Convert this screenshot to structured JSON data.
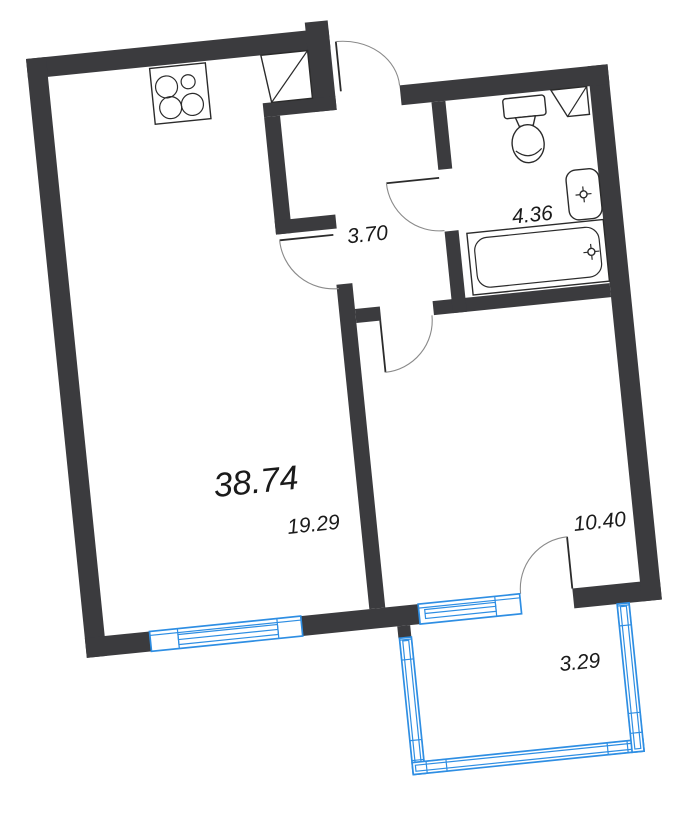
{
  "plan": {
    "type": "apartment-floor-plan",
    "rotation_deg": -5.8,
    "colors": {
      "wall": "#3B3B3E",
      "fixture_outline": "#2B2B2B",
      "door_arc": "#8A8A8A",
      "window_blue": "#2E8EE3",
      "label_text": "#1A1A1A",
      "background": "#FFFFFF"
    },
    "labels": {
      "total_area": "38.74",
      "living_room": "19.29",
      "hallway": "3.70",
      "bathroom": "4.36",
      "room": "10.40",
      "balcony": "3.29"
    }
  }
}
